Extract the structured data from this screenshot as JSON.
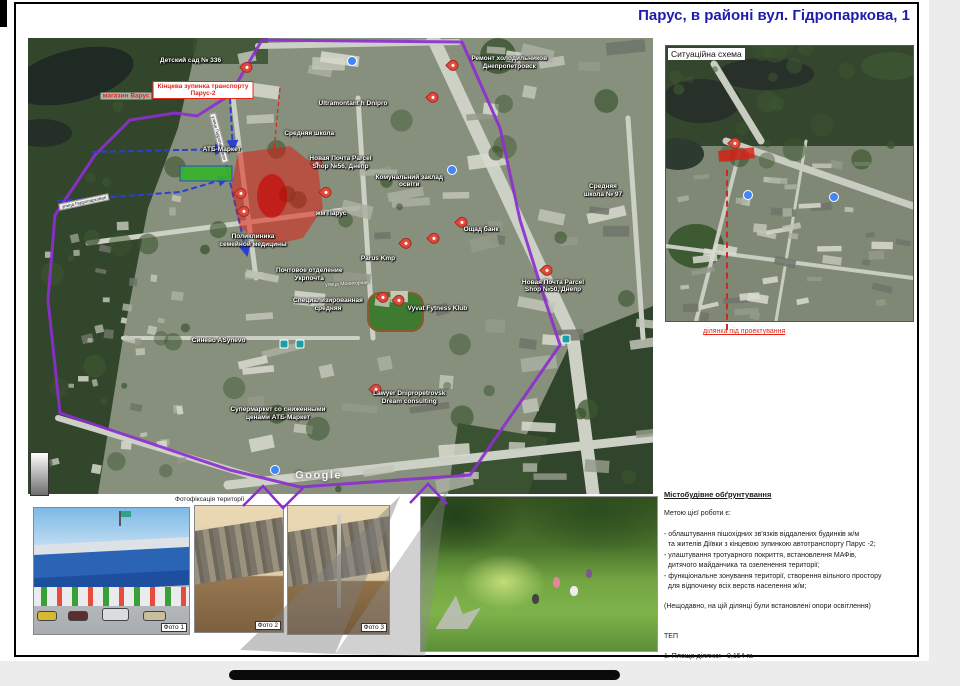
{
  "page": {
    "title": "Парус, в районі вул. Гідропаркова, 1"
  },
  "colors": {
    "title_blue": "#1d1dac",
    "boundary_purple": "#8c2fd0",
    "project_red": "#e03020",
    "path_blue": "#2b3fd4",
    "callout_red": "#cc2a1e"
  },
  "big_map": {
    "attribution": "Google",
    "annotations": {
      "varus_label": "магазин Варус",
      "terminus_label": "Кінцева зупинка транспорту\nПарус-2"
    },
    "labels": [
      "Детский сад № 336",
      "Ремонт холодильников\nДнепропетровск",
      "Ultramontant h Dnipro",
      "Средняя школа",
      "АТБ-Маркет",
      "Новая Почта Parcel\nShop №56, Днепр",
      "Комунальний заклад\nосвіти",
      "Средняя\nшкола № 97",
      "жм Парус",
      "Ощад банк",
      "Поликлиника\nсемейной медицины",
      "Parus Kmp",
      "Почтовое отделение\nУкрпочта",
      "Специализированная\nсредняя",
      "Vyvat Fytness Klub",
      "Новая Почта Parcel\nShop №50, Днепр",
      "Синево ASynevo",
      "Lawyer Dnipropetrovsk\nDream consulting",
      "Супермаркет со сниженными\nценами АТБ-Маркет"
    ],
    "street_labels": [
      "улица Гидропарковая",
      "улица Гидропарковая",
      "улица Мониторная"
    ]
  },
  "situational_map": {
    "title": "Ситуаційна схема",
    "callout": "ділянка під проектування"
  },
  "photos": {
    "caption": "Фотофіксація території",
    "labels": [
      "Фото 1",
      "Фото 2",
      "Фото 3"
    ]
  },
  "justification": {
    "heading": "Містобудівне обґрунтування",
    "intro": "Метою цієї роботи є:",
    "bullets": [
      "- облаштування пішохідних зв'язків віддалених будинків ж/м\n  та жителів Діївки з кінцевою зупинкою автотранспорту Парус -2;",
      "- улаштування тротуарного покриття, встановлення МАФів,\n  дитячого майданчика та озеленення території;",
      "- функціональне зонування території, створення вільного простору\n  для відпочинку всіх верств населення ж/м;"
    ],
    "note": "(Нещодавно, на цій ділянці були встановлені опори освітлення)",
    "tep_heading": "ТЕП",
    "tep_area": "1. Площа ділянки - 0,154 га"
  }
}
